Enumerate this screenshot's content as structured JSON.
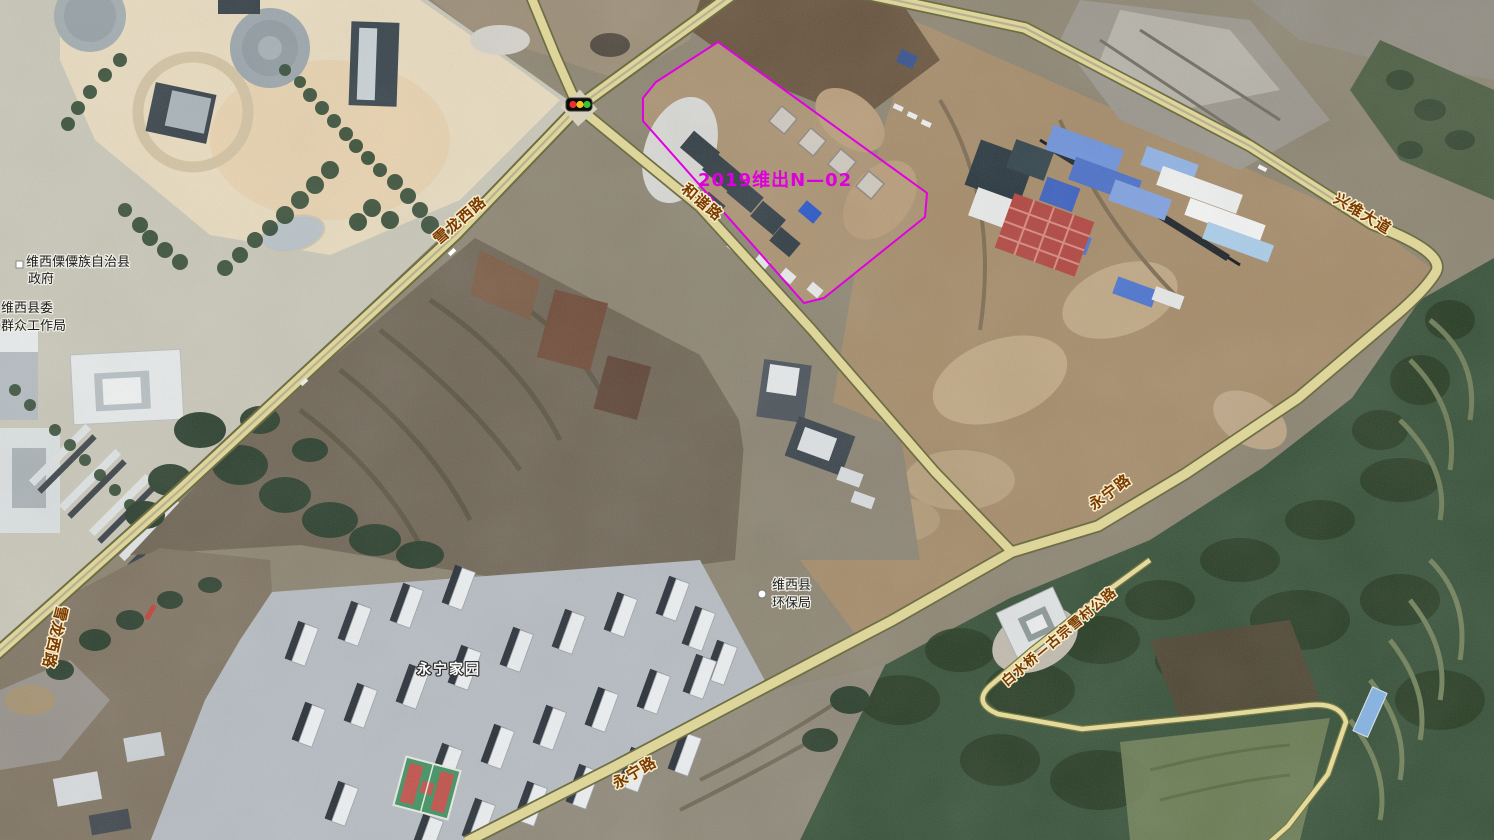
{
  "map": {
    "parcel": {
      "label": "2019维出N—02",
      "color": "#e000e0"
    },
    "roads": [
      {
        "id": "xuelong-west-upper",
        "label": "雪龙西路"
      },
      {
        "id": "xuelong-west-left",
        "label": "雪龙西路"
      },
      {
        "id": "hexie-road",
        "label": "和谐路"
      },
      {
        "id": "xingwei-avenue",
        "label": "兴维大道"
      },
      {
        "id": "yongning-road-east",
        "label": "永宁路"
      },
      {
        "id": "yongning-road-south",
        "label": "永宁路"
      },
      {
        "id": "baishuiqiao-road",
        "label": "白水桥—古宗雪村公路"
      }
    ],
    "pois": [
      {
        "id": "county-government",
        "lines": [
          "维西傈僳族自治县",
          "政府"
        ]
      },
      {
        "id": "masses-work-bureau",
        "lines": [
          "维西县委",
          "群众工作局"
        ]
      },
      {
        "id": "environment-bureau",
        "lines": [
          "维西县",
          "环保局"
        ]
      },
      {
        "id": "yongning-homeland",
        "lines": [
          "永宁家园"
        ]
      }
    ],
    "icons": {
      "traffic_light": "traffic-light-icon",
      "poi_marker_square": "square-marker",
      "poi_marker_circle": "circle-marker"
    },
    "colors": {
      "road_fill": "#ddd59a",
      "road_casing": "#6e6e46",
      "road_label": "#7b3a00",
      "road_label_halo": "#f6ecc9",
      "parcel_outline": "#e000e0",
      "parcel_label": "#dd00dd",
      "poi_label": "#1e1e1e",
      "poi_label_halo": "#f0efe8",
      "residential_label": "#ffffff",
      "traffic_light_red": "#ea2f2f",
      "traffic_light_yellow": "#f6c51c",
      "traffic_light_green": "#37c337"
    }
  }
}
